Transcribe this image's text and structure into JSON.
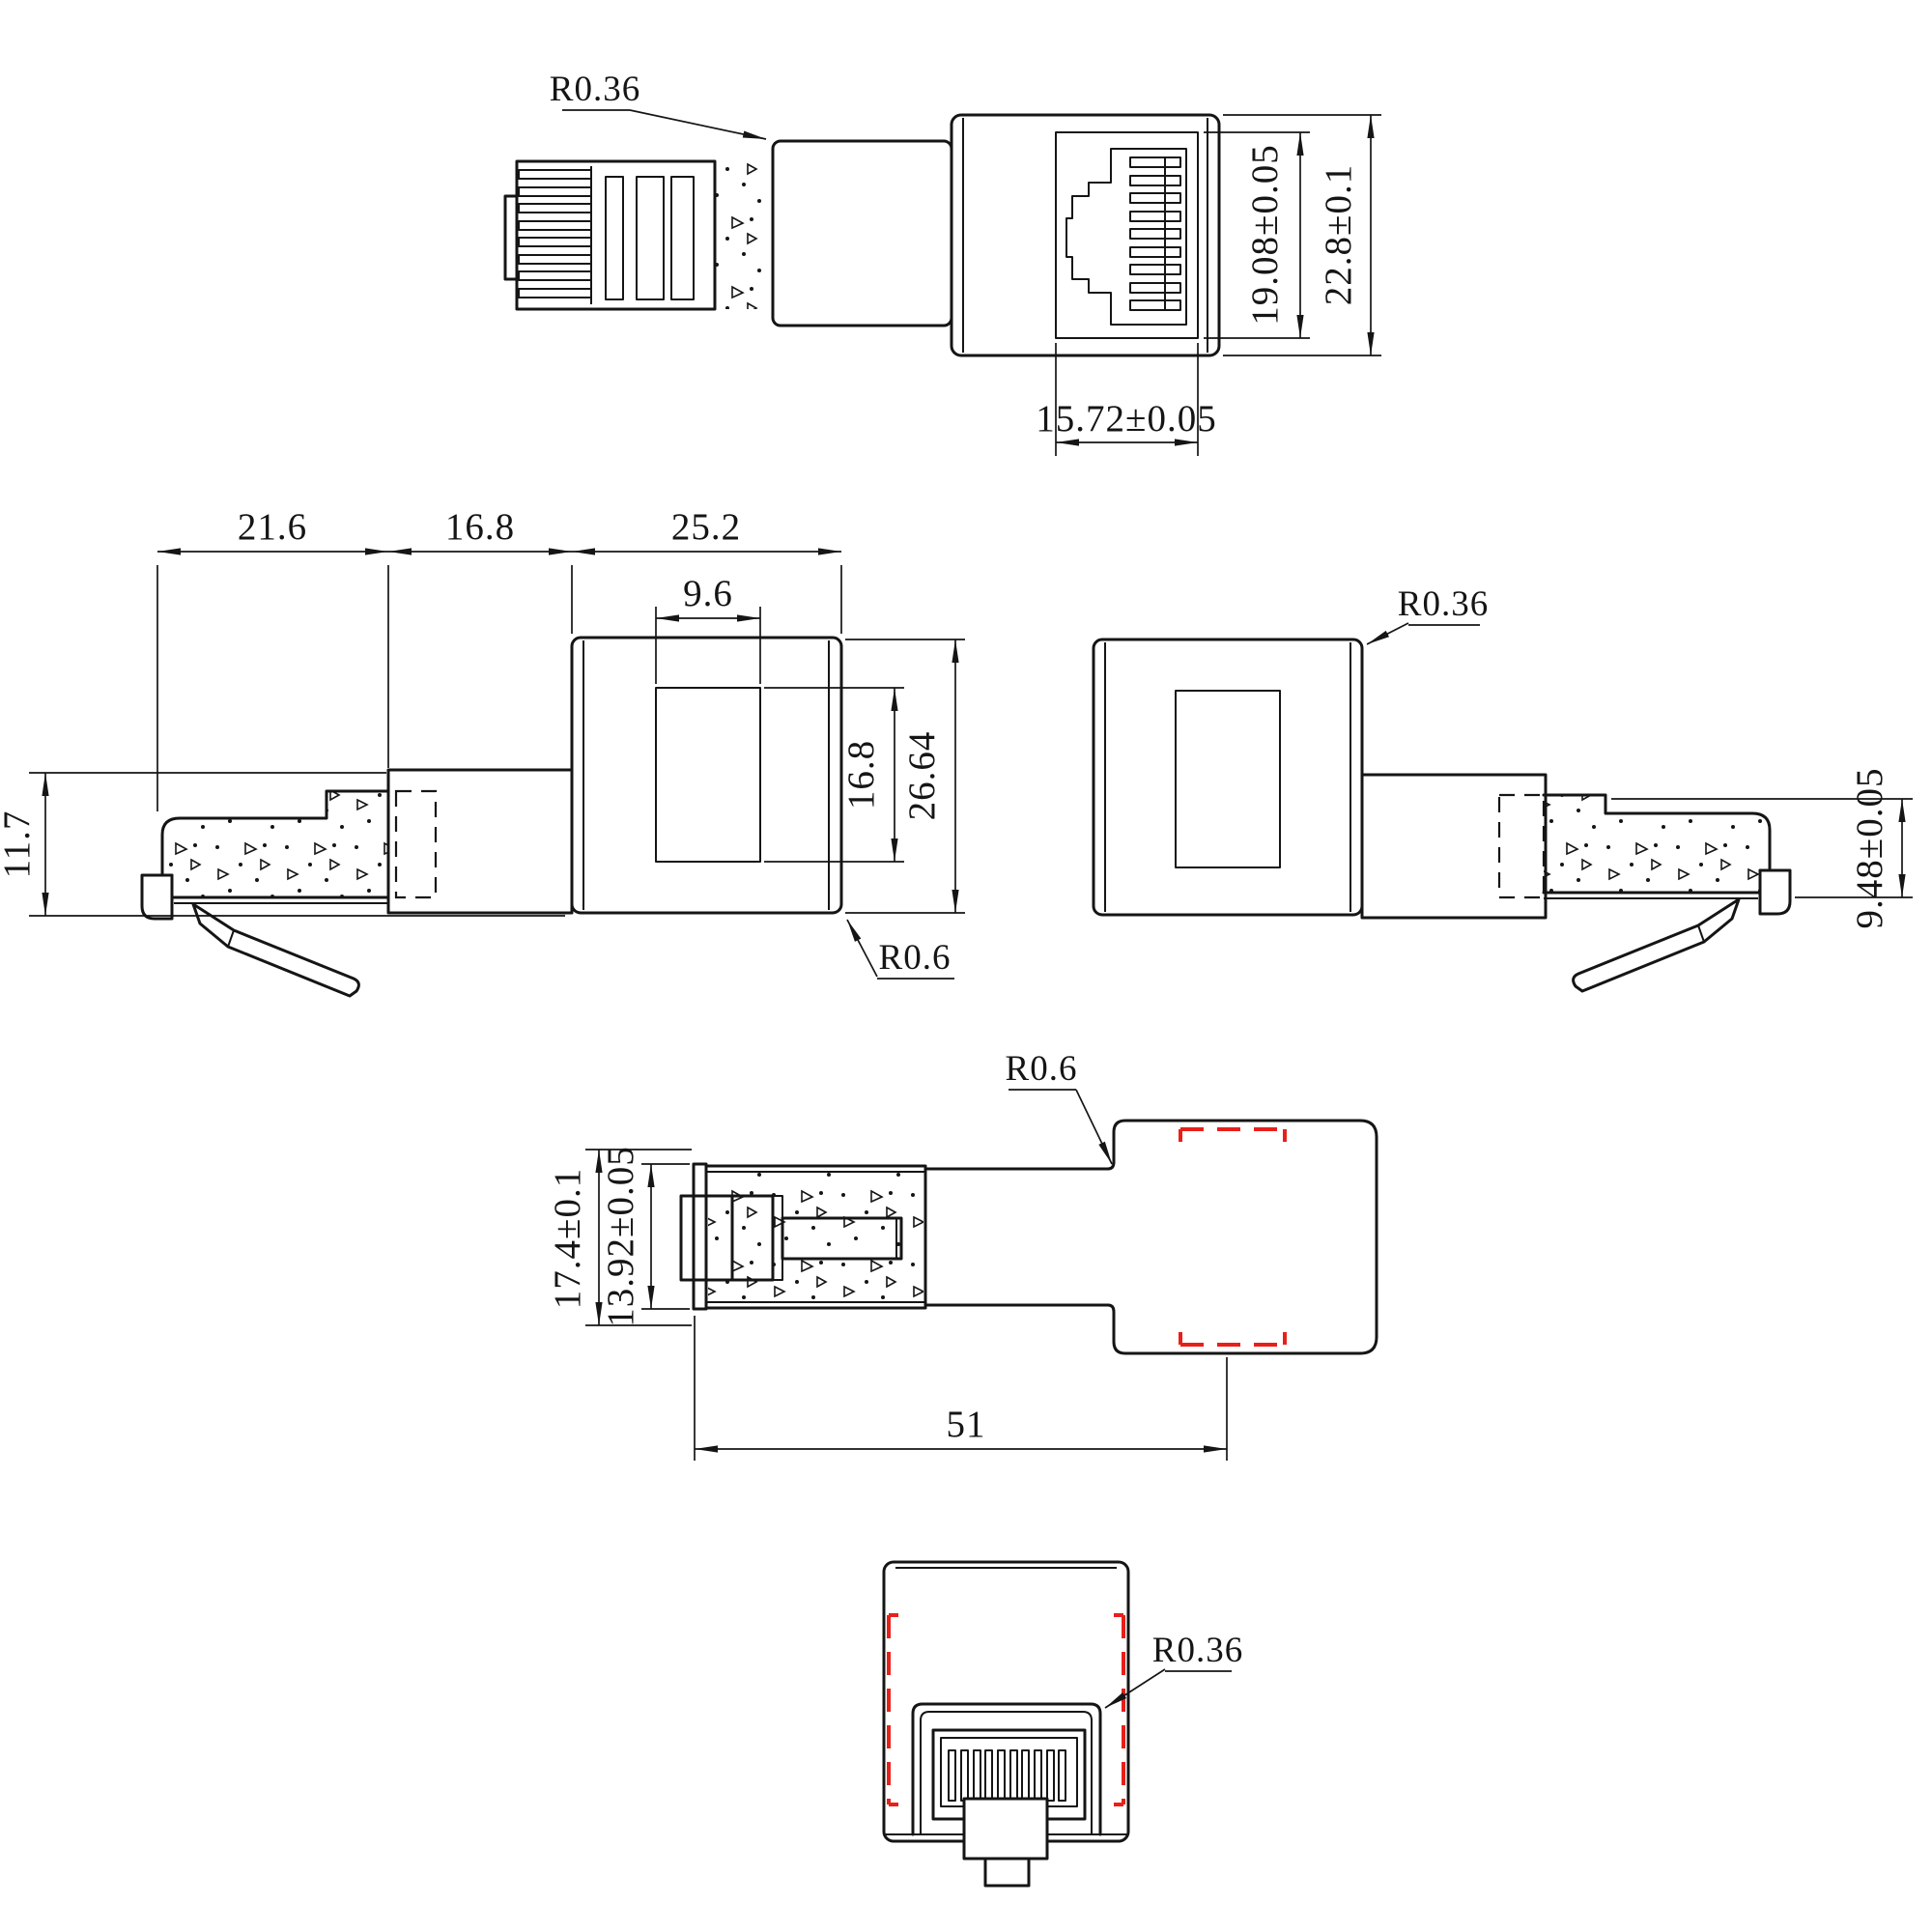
{
  "drawing": {
    "background": "#ffffff",
    "line_color": "#151515",
    "hidden_line_color": "#e8201a",
    "views": {
      "front_assembly": {
        "radius_label": "R0.36",
        "dim_jack_opening_height": "19.08±0.05",
        "dim_body_height": "22.8±0.1",
        "dim_jack_opening_width": "15.72±0.05"
      },
      "side_left": {
        "dim_plug_length": "21.6",
        "dim_neck_length": "16.8",
        "dim_body_length": "25.2",
        "dim_window_width": "9.6",
        "dim_window_height": "16.8",
        "dim_body_height": "26.64",
        "dim_plug_height": "11.7",
        "radius_label": "R0.6"
      },
      "side_right": {
        "radius_label": "R0.36",
        "dim_boot_height": "9.48±0.05"
      },
      "plan": {
        "radius_label": "R0.6",
        "dim_outer_height": "17.4±0.1",
        "dim_plug_height": "13.92±0.05",
        "dim_overall_length": "51"
      },
      "rear": {
        "radius_label": "R0.36"
      }
    }
  }
}
